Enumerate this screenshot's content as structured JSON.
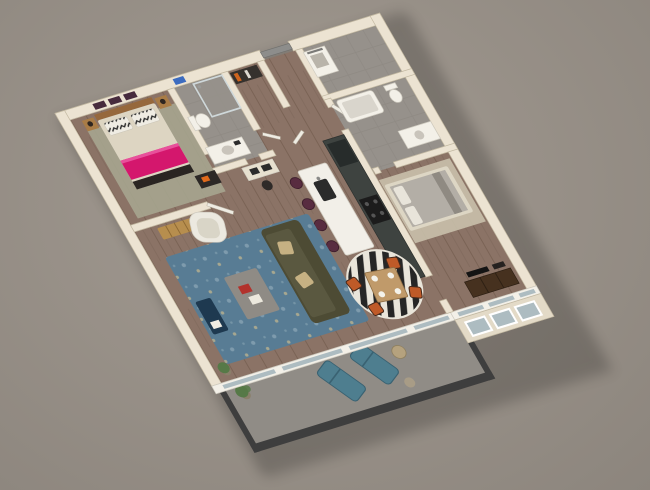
{
  "scene": {
    "label": "3D axonometric floor plan render of a one-bedroom-plus-den apartment with balcony",
    "view": "isometric-top-down",
    "background_style": "plain warm gray backdrop, soft drop shadow under unit"
  },
  "colors": {
    "bgCenter": "#a39b92",
    "bgEdge": "#8c857d",
    "wallTop": "#ece3d2",
    "wallEdge": "#c2b8a1",
    "facade": "#e3dac7",
    "glass": "#adbcc1",
    "floorWood": "#8b7366",
    "floorWoodLine": "#7a6355",
    "floorTile": "#96918b",
    "floorTileLine": "#8a857f",
    "balconyFloor": "#908c86",
    "parapet": "#3e3e3e",
    "fixtureWhite": "#f3f0e8",
    "fixtureShadow": "#d0ccc1",
    "rugSage": "#a6a58f",
    "rugBlue": "#587c94",
    "rugBlueDot": "#87a3b3",
    "rugBlueAccent": "#c8b98f",
    "bedLinen": "#ddd5c2",
    "bedPink": "#d4176d",
    "bedPinkLight": "#e8509b",
    "pillowWhite": "#efece3",
    "pillowBlack": "#2b2b2b",
    "headboard": "#96683c",
    "footboardDark": "#2a2522",
    "woodFurniture": "#b78e4e",
    "benchSlat": "#8f6a34",
    "nightstand": "#a97c46",
    "lampDark": "#2e2620",
    "artPurple": "#472b3d",
    "artBlue": "#3c6cc0",
    "closetDark": "#35312d",
    "doorGray": "#8d8d8b",
    "doorLeaf": "#efece3",
    "cabinets": "#3e4340",
    "cabinetTall": "#272c2b",
    "applianceBlack": "#1c1c1c",
    "burner": "#555555",
    "island": "#f2efe8",
    "sinkDark": "#2b2b2b",
    "stoolPlum": "#582c40",
    "sofa": "#4d4b34",
    "sofaSeat": "#5a5840",
    "sofaPillow": "#c6b183",
    "armchair": "#ece9e0",
    "armchairSeat": "#d9d5c7",
    "coffeeTable": "#8f8b85",
    "bookRed": "#b2322c",
    "bookWhite": "#ece8dd",
    "sideTableNavy": "#1e3950",
    "diningTable": "#c09a6a",
    "chairRust": "#bf5a28",
    "chairFrame": "#46281a",
    "stripeDark": "#262626",
    "stripeLight": "#e9e5da",
    "plateWhite": "#f4f2ea",
    "bedGray": "#b3aea6",
    "bedGrayFrame": "#ddd6c4",
    "bedGrayPillow": "#e8e4da",
    "bedRugTan": "#c9c0ab",
    "dresser": "#46311f",
    "tvBlack": "#141414",
    "lounger": "#4e7e8f",
    "loungerEdge": "#3a6272",
    "tableTan": "#b5a27e",
    "stoolTan": "#a89c86",
    "plantGreen": "#567947",
    "potTan": "#8a7f6a",
    "deskDark": "#2c2826",
    "deskTop": "#e7e0cf",
    "orangeAccent": "#e06a1c",
    "chairBlack": "#2e2a28",
    "tubInner": "#d9d5cc",
    "sinkBasin": "#c9c4bb"
  }
}
